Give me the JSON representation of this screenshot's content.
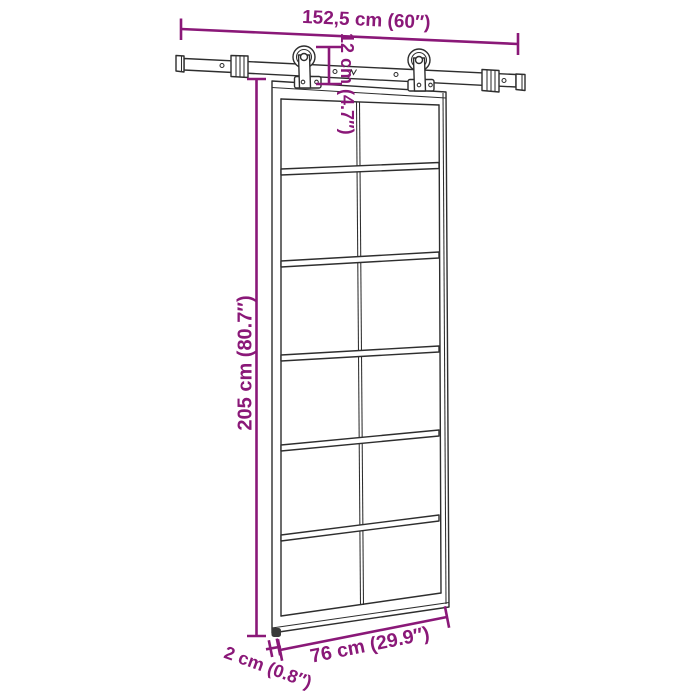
{
  "meta": {
    "image_type": "product dimension diagram",
    "subject": "sliding barn door with top-mounted rail and roller hardware"
  },
  "style": {
    "dimension_color": "#8a1878",
    "line_color": "#2e2e2e",
    "background": "#ffffff"
  },
  "dimensions": {
    "rail_width": "152,5 cm (60″)",
    "hardware_drop": "12 cm (4.7″)",
    "door_height": "205 cm (80.7″)",
    "door_width": "76 cm (29.9″)",
    "door_thickness": "2 cm (0.8″)"
  },
  "door": {
    "glass_rows": 6,
    "glass_columns": 2,
    "rollers": 2
  }
}
